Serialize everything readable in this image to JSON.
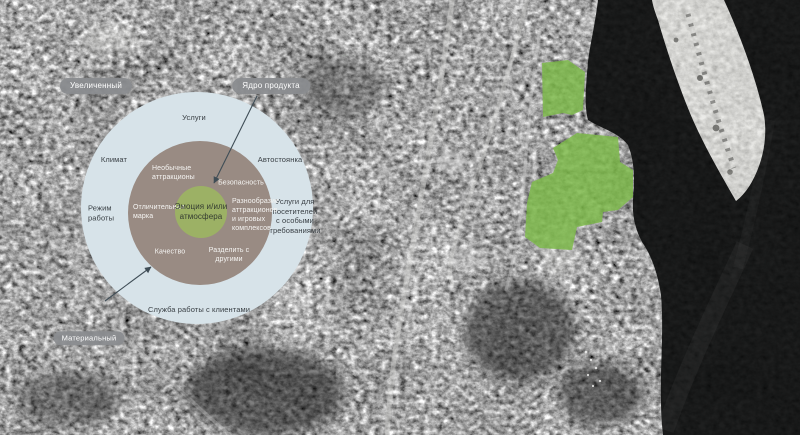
{
  "diagram": {
    "badges": {
      "augmented": "Увеличенный",
      "core": "Ядро продукта",
      "material": "Материальный"
    },
    "outer_ring": {
      "services": "Услуги",
      "climate": "Климат",
      "parking": "Автостоянка",
      "working_hours": "Режим\nработы",
      "special_needs": "Услуги для\nпосетителей\nс особыми\nтребованиями",
      "customer_service": "Служба работы с клиентами"
    },
    "middle_ring": {
      "unusual_attractions": "Необычные\nаттракционы",
      "safety": "Безопасность",
      "brand": "Отличительная\nмарка",
      "variety": "Разнообразие\nаттракционов\nи игровых\nкомплексов",
      "quality": "Качество",
      "share": "Разделить с\nдругими"
    },
    "core_circle": {
      "emotion": "Эмоция и/или\nатмосфера"
    },
    "colors": {
      "outer_ring": "#d7e3e9",
      "middle_ring": "#998b83",
      "core_circle": "#9cb165",
      "badge": "#8a8c8f",
      "arrow": "#3f4d56",
      "dark_text": "#3a4045",
      "light_text": "#f5f4f2"
    }
  },
  "map": {
    "type": "grayscale satellite photo",
    "highlight_color": "#7cb94a",
    "features": [
      "urban-blocks",
      "roads",
      "river-water",
      "sandbar-island",
      "highlighted-site-north",
      "highlighted-site-south",
      "boats"
    ]
  }
}
